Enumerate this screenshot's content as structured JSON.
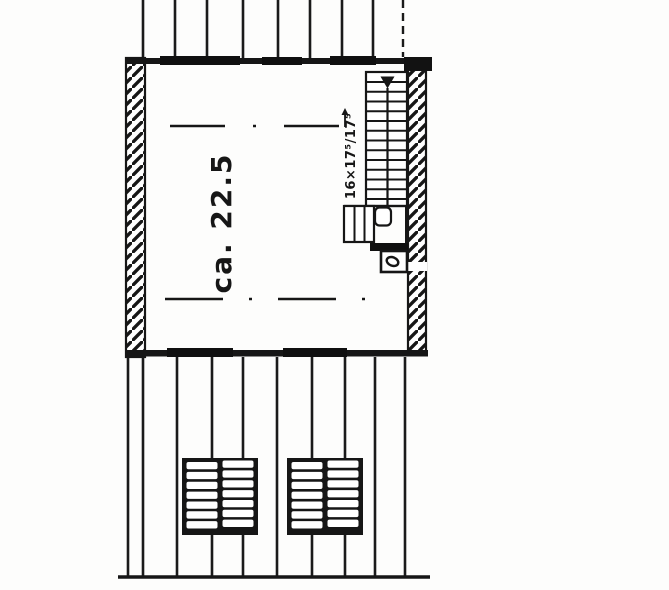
{
  "plan": {
    "ink_color": "#1a1a1a",
    "paper_color": "#fdfdfc",
    "room": {
      "area_label": "ca. 22.5"
    },
    "stairs": {
      "dimension_label": "16×17⁵/17⁵"
    }
  }
}
